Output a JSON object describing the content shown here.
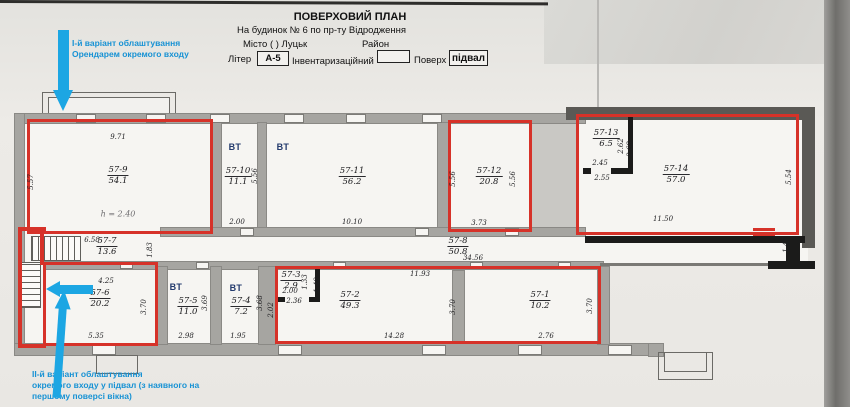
{
  "header": {
    "title": "ПОВЕРХОВИЙ ПЛАН",
    "subtitle": "На будинок № 6  по пр-ту Відродження",
    "city_label": "Місто (      ) Луцьк",
    "district_label": "Район",
    "liter_label": "Літер",
    "liter_value": "А-5",
    "inventory_label": "Інвентаризаційний",
    "inventory_value": "",
    "floor_label": "Поверх",
    "floor_value": "підвал"
  },
  "annotations": {
    "variant1": {
      "lines": [
        "І-й варіант облаштування",
        "Орендарем окремого входу"
      ]
    },
    "variant2": {
      "lines": [
        "ІІ-й варіант облаштування",
        "окремого входу у підвал (з наявного на",
        "першому поверсі вікна)"
      ]
    }
  },
  "plan": {
    "rooms": [
      {
        "num": "57-9",
        "area": "54.1",
        "x": 118,
        "y": 165
      },
      {
        "num": "57-10",
        "area": "11.1",
        "x": 238,
        "y": 166
      },
      {
        "num": "57-11",
        "area": "56.2",
        "x": 352,
        "y": 166
      },
      {
        "num": "57-12",
        "area": "20.8",
        "x": 489,
        "y": 166
      },
      {
        "num": "57-13",
        "area": "6.5",
        "x": 606,
        "y": 128
      },
      {
        "num": "57-14",
        "area": "57.0",
        "x": 676,
        "y": 164
      },
      {
        "num": "57-7",
        "area": "13.6",
        "x": 107,
        "y": 236
      },
      {
        "num": "57-8",
        "area": "50.8",
        "x": 458,
        "y": 236
      },
      {
        "num": "57-6",
        "area": "20.2",
        "x": 100,
        "y": 288
      },
      {
        "num": "57-5",
        "area": "11.0",
        "x": 188,
        "y": 296
      },
      {
        "num": "57-4",
        "area": "7.2",
        "x": 241,
        "y": 296
      },
      {
        "num": "57-3",
        "area": "2.9",
        "x": 291,
        "y": 270
      },
      {
        "num": "57-2",
        "area": "49.3",
        "x": 350,
        "y": 290
      },
      {
        "num": "57-1",
        "area": "10.2",
        "x": 540,
        "y": 290
      }
    ],
    "bt_labels": [
      {
        "t": "ВТ",
        "x": 235,
        "y": 147
      },
      {
        "t": "ВТ",
        "x": 283,
        "y": 147
      },
      {
        "t": "ВТ",
        "x": 176,
        "y": 287
      },
      {
        "t": "ВТ",
        "x": 236,
        "y": 288
      }
    ],
    "notes": [
      {
        "t": "h = 2.40",
        "x": 118,
        "y": 214
      }
    ],
    "dims": [
      {
        "t": "9.71",
        "x": 118,
        "y": 137
      },
      {
        "t": "5.57",
        "x": 31,
        "y": 182,
        "r": 1
      },
      {
        "t": "2.00",
        "x": 237,
        "y": 222
      },
      {
        "t": "5.56",
        "x": 255,
        "y": 176,
        "r": 1
      },
      {
        "t": "10.10",
        "x": 352,
        "y": 222
      },
      {
        "t": "3.73",
        "x": 479,
        "y": 223
      },
      {
        "t": "5.56",
        "x": 453,
        "y": 179,
        "r": 1
      },
      {
        "t": "5.56",
        "x": 513,
        "y": 179,
        "r": 1
      },
      {
        "t": "2.45",
        "x": 600,
        "y": 163
      },
      {
        "t": "2.55",
        "x": 602,
        "y": 178
      },
      {
        "t": "2.62",
        "x": 621,
        "y": 146,
        "r": 1
      },
      {
        "t": "2.68",
        "x": 630,
        "y": 149,
        "r": 1
      },
      {
        "t": "11.50",
        "x": 663,
        "y": 219
      },
      {
        "t": "5.54",
        "x": 789,
        "y": 177,
        "r": 1
      },
      {
        "t": "1.47",
        "x": 786,
        "y": 245,
        "r": 1
      },
      {
        "t": "6.58",
        "x": 92,
        "y": 240
      },
      {
        "t": "1.83",
        "x": 150,
        "y": 250,
        "r": 1
      },
      {
        "t": "34.56",
        "x": 473,
        "y": 258
      },
      {
        "t": "4.25",
        "x": 106,
        "y": 281
      },
      {
        "t": "5.35",
        "x": 96,
        "y": 336
      },
      {
        "t": "3.70",
        "x": 144,
        "y": 307,
        "r": 1
      },
      {
        "t": "2.98",
        "x": 186,
        "y": 336
      },
      {
        "t": "3.69",
        "x": 205,
        "y": 303,
        "r": 1
      },
      {
        "t": "1.95",
        "x": 238,
        "y": 336
      },
      {
        "t": "3.68",
        "x": 260,
        "y": 303,
        "r": 1
      },
      {
        "t": "2.00",
        "x": 290,
        "y": 291
      },
      {
        "t": "2.36",
        "x": 294,
        "y": 301
      },
      {
        "t": "1.33",
        "x": 305,
        "y": 282,
        "r": 1
      },
      {
        "t": "1.49",
        "x": 317,
        "y": 285,
        "r": 1
      },
      {
        "t": "2.02",
        "x": 271,
        "y": 310,
        "r": 1
      },
      {
        "t": "11.93",
        "x": 420,
        "y": 274
      },
      {
        "t": "14.28",
        "x": 394,
        "y": 336
      },
      {
        "t": "3.70",
        "x": 453,
        "y": 307,
        "r": 1
      },
      {
        "t": "2.76",
        "x": 546,
        "y": 336
      },
      {
        "t": "3.70",
        "x": 590,
        "y": 306,
        "r": 1
      }
    ]
  },
  "colors": {
    "highlight_red": "#d63229",
    "annotation_blue": "#1ca6e3",
    "bt_navy": "#233a6d",
    "paper": "#e9e7e3"
  }
}
